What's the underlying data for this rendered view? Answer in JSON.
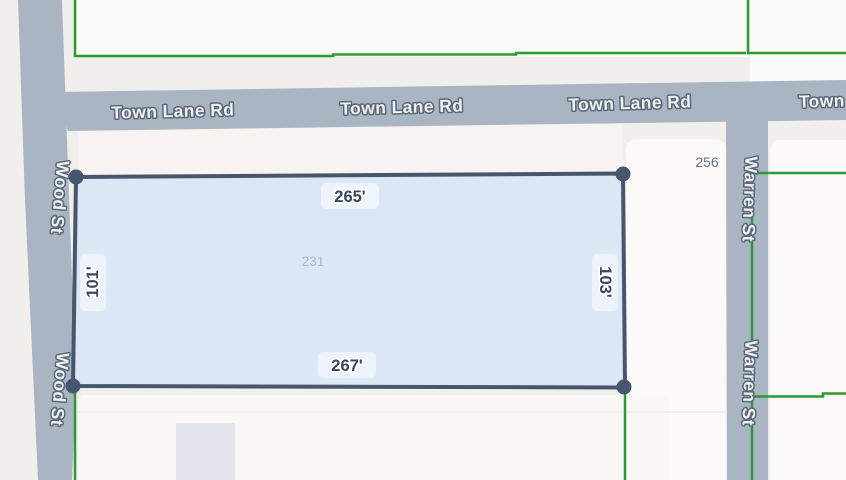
{
  "map": {
    "roads": {
      "town_lane_rd": "Town Lane Rd",
      "town_lane_rd_partial": "Town",
      "wood_st": "Wood St",
      "warren_st": "Warren St"
    },
    "selected_parcel": {
      "number": "231",
      "dimensions": {
        "top": "265'",
        "bottom": "267'",
        "left": "101'",
        "right": "103'"
      },
      "fill_color": "#d9e7f5",
      "border_color": "#47566e"
    },
    "adjacent_parcel": {
      "number": "256"
    },
    "colors": {
      "background": "#f1efec",
      "road": "#a9b5c2",
      "parcel_boundary_green": "#2c9a34",
      "building": "#e3e7ed"
    }
  }
}
